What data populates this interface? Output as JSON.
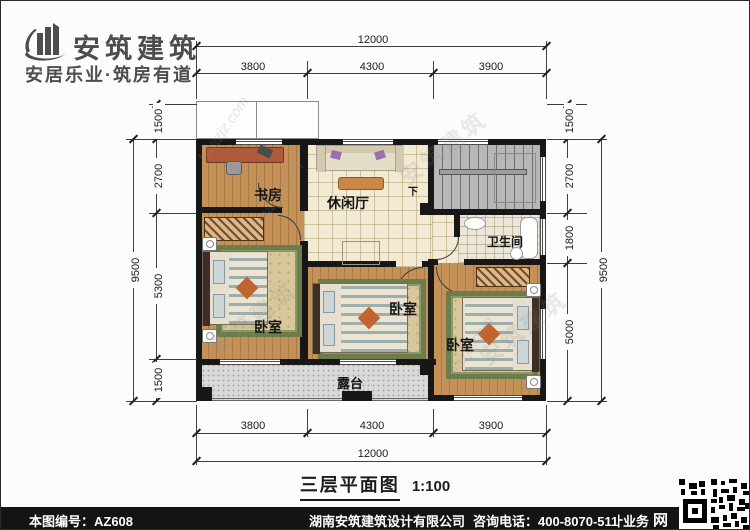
{
  "brand": {
    "name": "安筑建筑",
    "tagline": "安居乐业·筑房有道"
  },
  "plan": {
    "rooms": {
      "study": "书房",
      "lounge": "休闲厅",
      "bathroom": "卫生间",
      "bedroom_left": "卧室",
      "bedroom_middle": "卧室",
      "bedroom_right": "卧室",
      "terrace": "露台",
      "stairs_down_label": "下"
    },
    "caption": {
      "title": "三层平面图",
      "scale": "1:100"
    }
  },
  "dimensions": {
    "top": {
      "overall": "12000",
      "segments": [
        "3800",
        "4300",
        "3900"
      ]
    },
    "bottom": {
      "overall": "12000",
      "segments": [
        "3800",
        "4300",
        "3900"
      ]
    },
    "left": {
      "overall": "9500",
      "segments": [
        "1500",
        "2700",
        "5300",
        "1500"
      ]
    },
    "right": {
      "overall": "9500",
      "segments": [
        "1500",
        "2700",
        "1800",
        "5000"
      ]
    }
  },
  "watermarks": {
    "brand": "安筑建筑",
    "site": "hnazjz.com"
  },
  "footer": {
    "drawing_no": "本图编号：AZ608",
    "company": "湖南安筑建筑设计有限公司",
    "service": "专业承接全国别墅设计业务",
    "phone": "咨询电话：400-8070-511",
    "web_icon": "网"
  },
  "colors": {
    "wall": "#171717",
    "wood_floor": "#c49258",
    "tile_floor": "#f2ead4",
    "stair_gray": "#b7b7b7",
    "terrace_gray": "#d9d9d9",
    "rug_green": "#6d7c4c",
    "footer_bg": "#141414"
  }
}
